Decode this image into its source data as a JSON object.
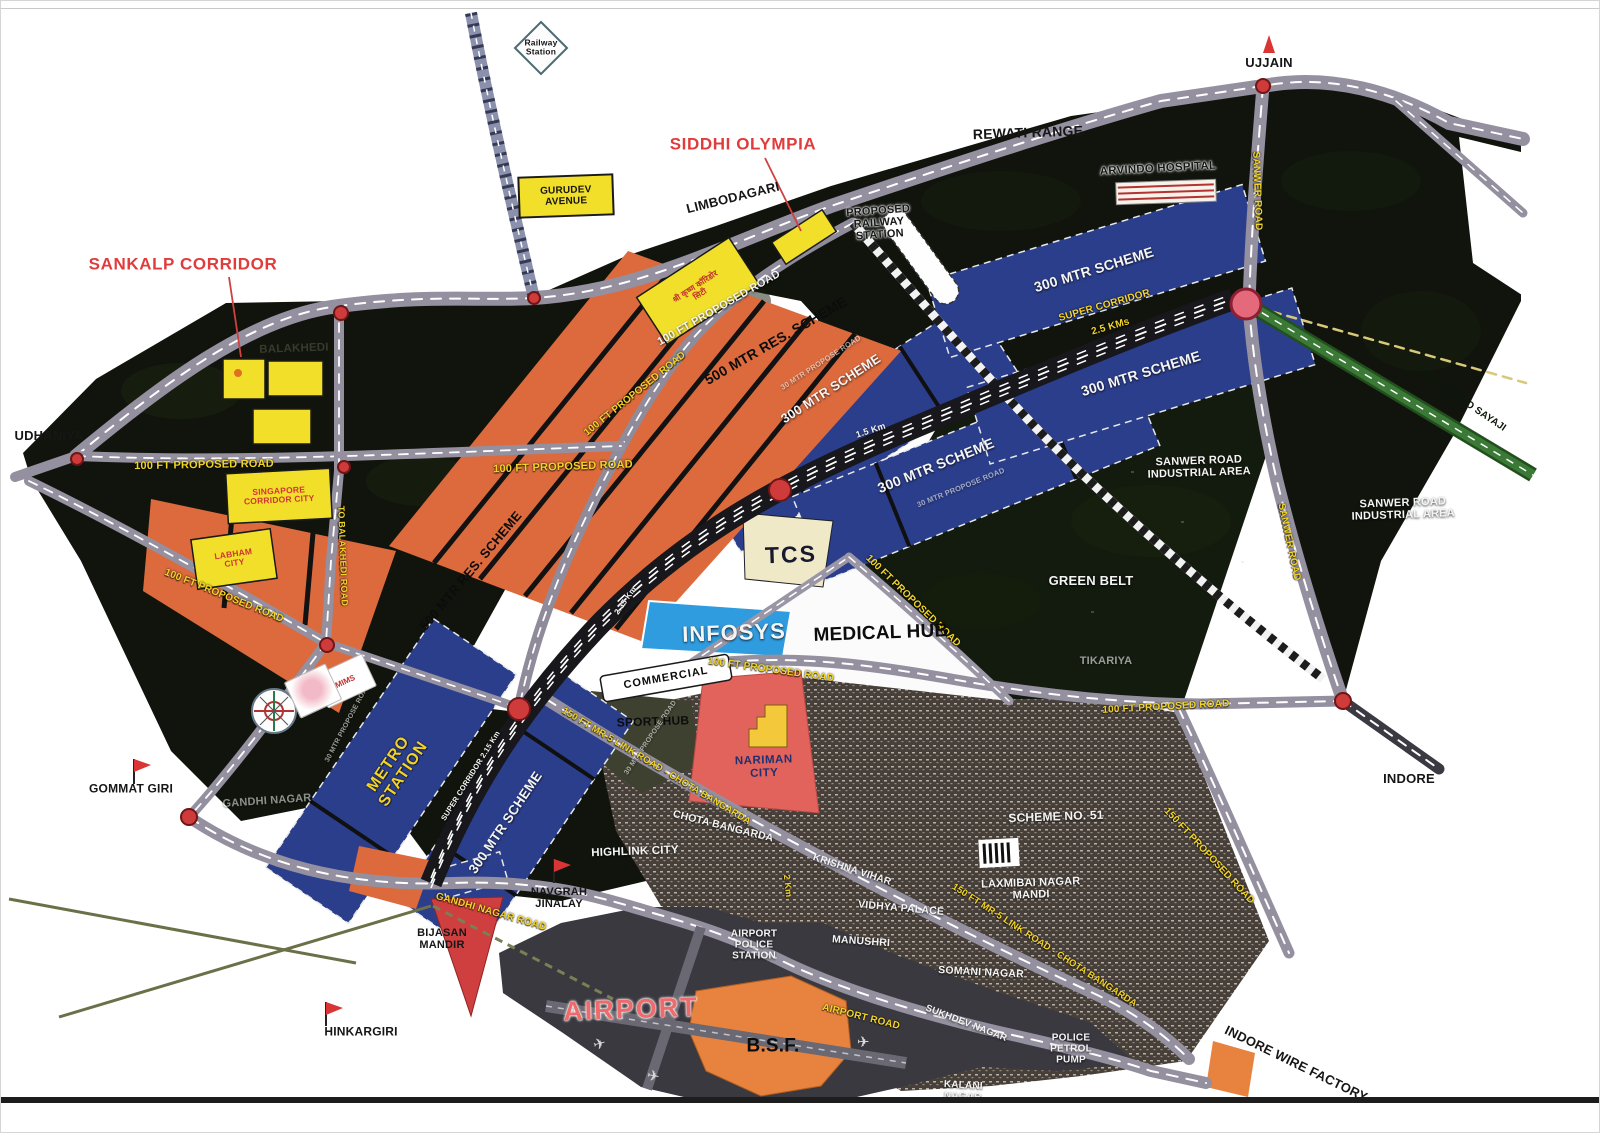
{
  "colors": {
    "scheme_orange": "#dc6a3d",
    "scheme_blue": "#2b3e8c",
    "infosys_blue": "#2f9cdf",
    "corridor_black": "#17171c",
    "road_gray": "#94909f",
    "railway_gray": "#8b90ad",
    "green_road": "#3a7a36",
    "plot_yellow": "#f2df2a",
    "marker_red": "#cf3a3a",
    "label_yellow": "#f3d426",
    "label_red": "#e03c3c",
    "nariman_red": "#e2635c",
    "bsf_orange": "#e8833f",
    "dark_land": "#10140c",
    "urban_brown": "#473f39"
  },
  "landmarks": {
    "railway_station": "Railway\nStation",
    "siddhi_olympia": "SIDDHI OLYMPIA",
    "sankalp_corridor": "SANKALP CORRIDOR",
    "gurudev_avenue": "GURUDEV\nAVENUE",
    "proposed_railway_station": "PROPOSED\nRAILWAY\nSTATION",
    "rewati_range": "REWATI RANGE",
    "arvindo_hospital": "ARVINDO HOSPITAL",
    "ujjain": "UJJAIN",
    "udhaniya": "UDHANIYA",
    "balakhedi": "BALAKHEDI",
    "singapore_corridor_city": "SINGAPORE\nCORRIDOR CITY",
    "labham_city": "LABHAM\nCITY",
    "shri_krishna_city": "श्री कृष्ण कॉरिडोर\nसिटी",
    "tcs": "TCS",
    "infosys": "INFOSYS",
    "medical_hub": "MEDICAL HUB",
    "commercial": "COMMERCIAL",
    "sport_hub": "SPORT HUB",
    "nariman_city": "NARIMAN\nCITY",
    "metro_station": "METRO\nSTATION",
    "green_belt": "GREEN BELT",
    "tikariya": "TIKARIYA",
    "sanwer_road_industrial_area": "SANWER ROAD\nINDUSTRIAL AREA",
    "gommat_giri": "GOMMAT GIRI",
    "gandhi_nagar": "GANDHI NAGAR",
    "highlink_city": "HIGHLINK CITY",
    "navgrah_jinalay": "NAVGRAH\nJINALAY",
    "bijasan_mandir": "BIJASAN\nMANDIR",
    "hinkargiri": "HINKARGIRI",
    "airport": "AIRPORT",
    "bsf": "B.S.F.",
    "airport_police_station": "AIRPORT\nPOLICE\nSTATION",
    "chota_bangarda": "CHOTA BANGARDA",
    "krishna_vihar": "KRISHNA VIHAR",
    "vidhya_palace": "VIDHYA PALACE",
    "manushri": "MANUSHRI",
    "somani_nagar": "SOMANI NAGAR",
    "sukhdev_nagar": "SUKHDEV NAGAR",
    "kalani_nagar": "KALANI\nNAGAR",
    "laxmibai_nagar_mandi": "LAXMIBAI NAGAR\nMANDI",
    "scheme_no_51": "SCHEME NO. 51",
    "police_petrol_pump": "POLICE\nPETROL\nPUMP",
    "indore_wire_factory": "INDORE WIRE FACTORY",
    "indore": "INDORE",
    "mims": "MIMS"
  },
  "roads": {
    "limbodagari": "LIMBODAGARI",
    "sanwer_road": "SANWER ROAD",
    "super_corridor": "SUPER CORRIDOR",
    "mr_ten_to_sayaji": "M.R. TEN TO SAYAJI",
    "road_100ft": "100 FT PROPOSED ROAD",
    "road_30mtr": "30 MTR PROPOSE ROAD",
    "to_balakhedi_road": "TO BALAKHEDI ROAD",
    "gandhi_nagar_road": "GANDHI NAGAR ROAD",
    "airport_road": "AIRPORT ROAD",
    "link_road_150": "150 FT MR-5 LINK ROAD - CHOTA BANGARDA",
    "road_150ft": "150 FT PROPOSED ROAD"
  },
  "schemes": {
    "s500": "500 MTR RES. SCHEME",
    "s300": "300 MTR SCHEME"
  },
  "markers": {
    "km_15": "1.5 Km",
    "km_2": "2 Km",
    "km_235": "2.35 Km",
    "km_25": "2.5 KMs",
    "km_215": "2.15 Km"
  },
  "icons": {
    "plane": "✈"
  }
}
